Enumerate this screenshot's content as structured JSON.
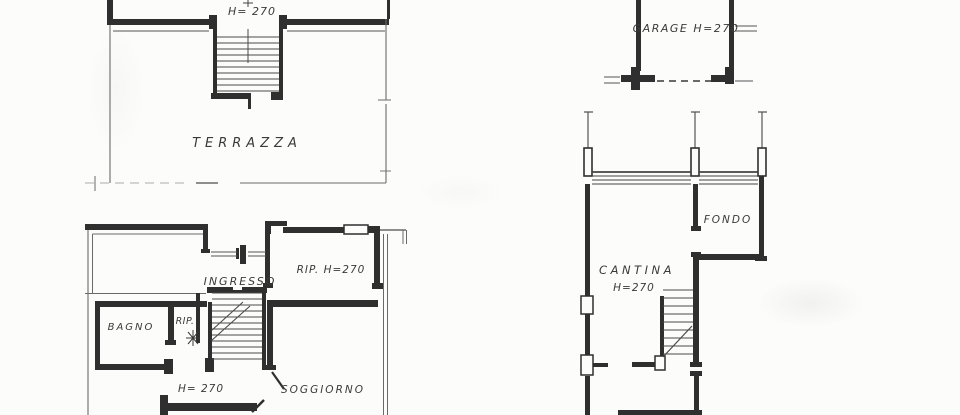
{
  "document": {
    "type": "scanned architectural floor plan",
    "sheet_width_px": 960,
    "sheet_height_px": 415
  },
  "colors": {
    "paper": "#fcfcfb",
    "ink": "#2f2f2f",
    "thin_line": "#6a6a6a",
    "text": "#3a3a3a"
  },
  "plans": {
    "attic": {
      "height_label": "H= 270",
      "terrace_label": "TERRAZZA"
    },
    "garage": {
      "label": "GARAGE H=270"
    },
    "main_floor": {
      "ingresso": "INGRESSO",
      "rip_large": "RIP. H=270",
      "bagno": "BAGNO",
      "rip_small": "RIP.",
      "height_label": "H= 270",
      "soggiorno": "SOGGIORNO"
    },
    "basement": {
      "fondo": "FONDO",
      "cantina": "CANTINA",
      "height_label": "H=270"
    }
  }
}
